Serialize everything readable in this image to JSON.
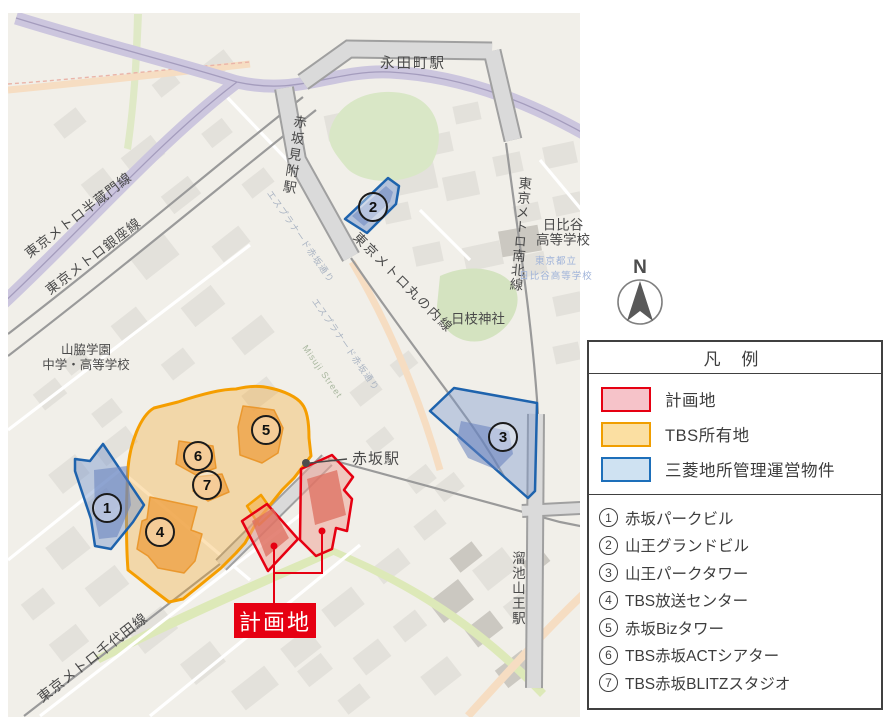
{
  "compass": {
    "north_label": "N"
  },
  "map": {
    "station_labels": {
      "nagatacho": "永田町駅",
      "akasaka_mitsuke": "赤坂見附駅",
      "akasaka": "赤坂駅",
      "tameike_sanno": "溜池山王駅"
    },
    "line_labels": {
      "hanzomon": "東京メトロ半蔵門線",
      "ginza": "東京メトロ銀座線",
      "namboku": "東京メトロ南北線",
      "marunouchi": "東京メトロ丸の内線",
      "chiyoda": "東京メトロ千代田線"
    },
    "place_labels": {
      "hibiya_line1": "日比谷",
      "hibiya_line2": "高等学校",
      "hibiya_small1": "東京都立",
      "hibiya_small2": "日比谷高等学校",
      "hie_shrine": "日枝神社",
      "yamawaki_line1": "山脇学園",
      "yamawaki_line2": "中学・高等学校",
      "esplanade": "エスプラナード赤坂通り",
      "misuji": "Misuji Street"
    },
    "planned_site_callout": "計画地",
    "markers": [
      "1",
      "2",
      "3",
      "4",
      "5",
      "6",
      "7"
    ]
  },
  "legend": {
    "title": "凡 例",
    "items": [
      {
        "label": "計画地",
        "fill": "#f6c3c9",
        "border": "#e60012"
      },
      {
        "label": "TBS所有地",
        "fill": "#fbdfa2",
        "border": "#f09e00"
      },
      {
        "label": "三菱地所管理運営物件",
        "fill": "#cfe2f2",
        "border": "#1d6fba"
      }
    ],
    "buildings": [
      {
        "no": "1",
        "name": "赤坂パークビル"
      },
      {
        "no": "2",
        "name": "山王グランドビル"
      },
      {
        "no": "3",
        "name": "山王パークタワー"
      },
      {
        "no": "4",
        "name": "TBS放送センター"
      },
      {
        "no": "5",
        "name": "赤坂Bizタワー"
      },
      {
        "no": "6",
        "name": "TBS赤坂ACTシアター"
      },
      {
        "no": "7",
        "name": "TBS赤坂BLITZスタジオ"
      }
    ]
  }
}
